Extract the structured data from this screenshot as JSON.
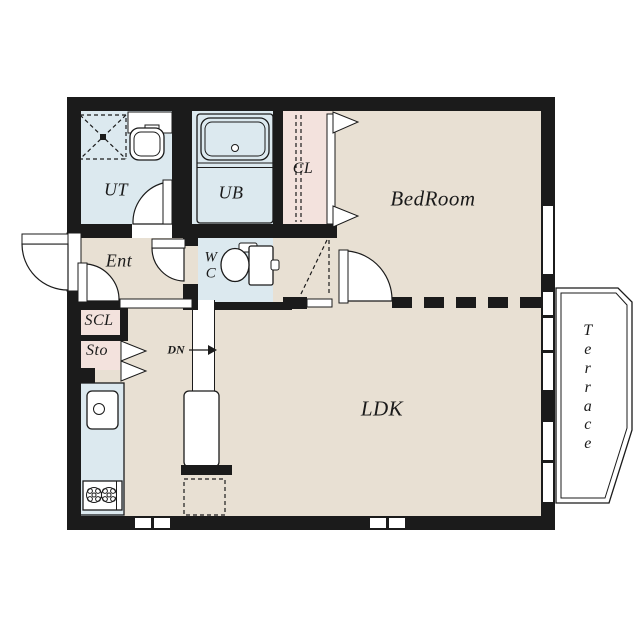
{
  "floorplan": {
    "rooms": {
      "ut": "UT",
      "ub": "UB",
      "cl": "CL",
      "bedroom": "BedRoom",
      "ent": "Ent",
      "wc_line1": "W",
      "wc_line2": "C",
      "scl": "SCL",
      "sto": "Sto",
      "ldk": "LDK",
      "terrace": "Terrace"
    },
    "stairs": {
      "down_label": "DN"
    },
    "colors": {
      "wall": "#1b1b1b",
      "beige": "#e8e0d3",
      "blue": "#dce9ef",
      "pink": "#f3e2dd",
      "terrace": "#f6f3d9",
      "line": "#1b1b1b"
    }
  }
}
